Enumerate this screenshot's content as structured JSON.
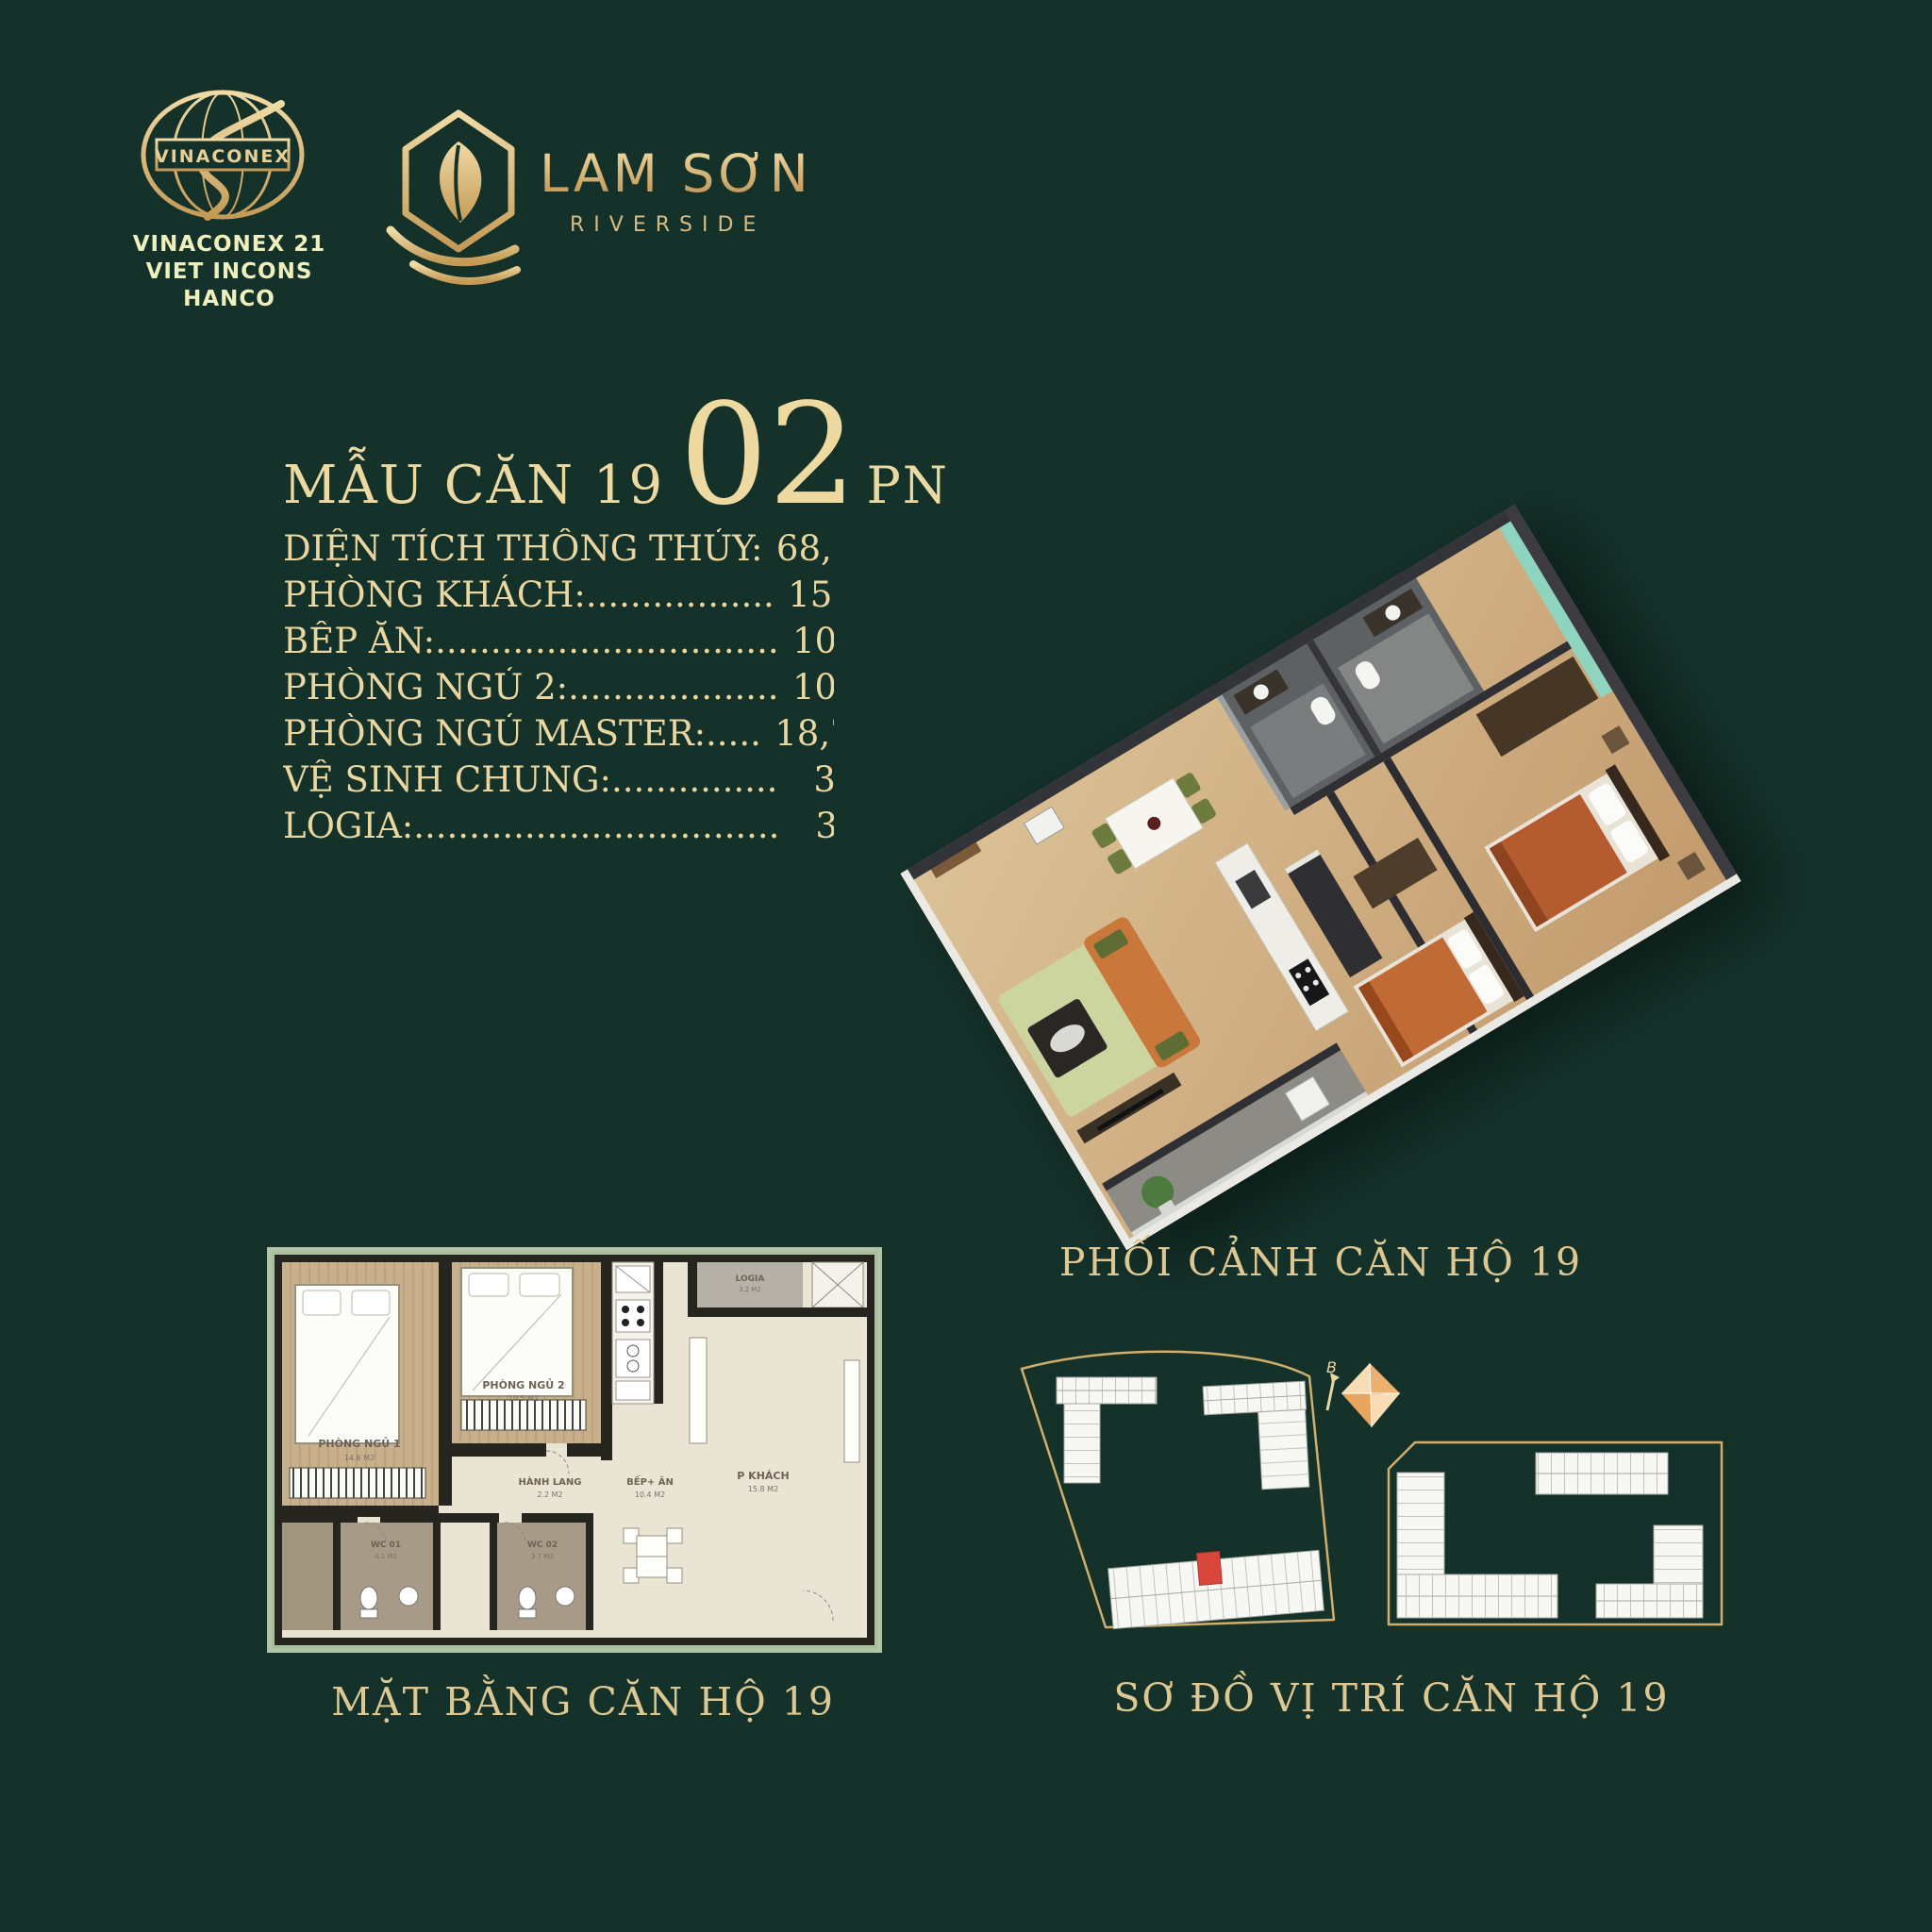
{
  "colors": {
    "background": "#15322a",
    "gold": "#d7b97f",
    "gold_light": "#ecd9a4",
    "pale_yellow": "#eef1be",
    "highlight_red": "#d8463c"
  },
  "header": {
    "developer": {
      "logo_text": "VINACONEX",
      "lines": [
        "VINACONEX 21",
        "VIET INCONS",
        "HANCO"
      ]
    },
    "project": {
      "name": "LAM SƠN",
      "subtitle": "RIVERSIDE"
    }
  },
  "unit": {
    "title": {
      "prefix": "MẪU CĂN 19",
      "number": "02",
      "suffix": "PN"
    },
    "specs": [
      {
        "label": "DIỆN TÍCH THÔNG THỦY:",
        "value": "68,5 M2"
      },
      {
        "label": "PHÒNG KHÁCH:.................",
        "value": "15,8 M2"
      },
      {
        "label": "BẾP ĂN:...............................",
        "value": "10,4 M2"
      },
      {
        "label": "PHÒNG NGỦ 2:...................",
        "value": "10,5 M2"
      },
      {
        "label": "PHÒNG NGỦ MASTER:.....",
        "value": "18,7 M2"
      },
      {
        "label": "VỆ SINH CHUNG:...............",
        "value": "3,7 M2"
      },
      {
        "label": "LOGIA:.................................",
        "value": "3,2 M2"
      }
    ]
  },
  "perspective": {
    "caption": "PHỐI CẢNH CĂN HỘ 19"
  },
  "floorplan": {
    "caption": "MẶT BẰNG CĂN HỘ 19",
    "rooms": [
      {
        "name": "PHÒNG NGỦ 1",
        "area": "14.6 M2"
      },
      {
        "name": "PHÒNG NGỦ 2",
        "area": "10.5 M2"
      },
      {
        "name": "LOGIA",
        "area": "3.2 M2"
      },
      {
        "name": "HÀNH LANG",
        "area": "2.2 M2"
      },
      {
        "name": "BẾP+ ĂN",
        "area": "10.4 M2"
      },
      {
        "name": "P KHÁCH",
        "area": "15.8 M2"
      },
      {
        "name": "WC 01",
        "area": "4.1 M2"
      },
      {
        "name": "WC 02",
        "area": "3.7 M2"
      }
    ]
  },
  "sitemap": {
    "caption": "SƠ ĐỒ VỊ TRÍ CĂN HỘ 19",
    "north_label": "B"
  }
}
